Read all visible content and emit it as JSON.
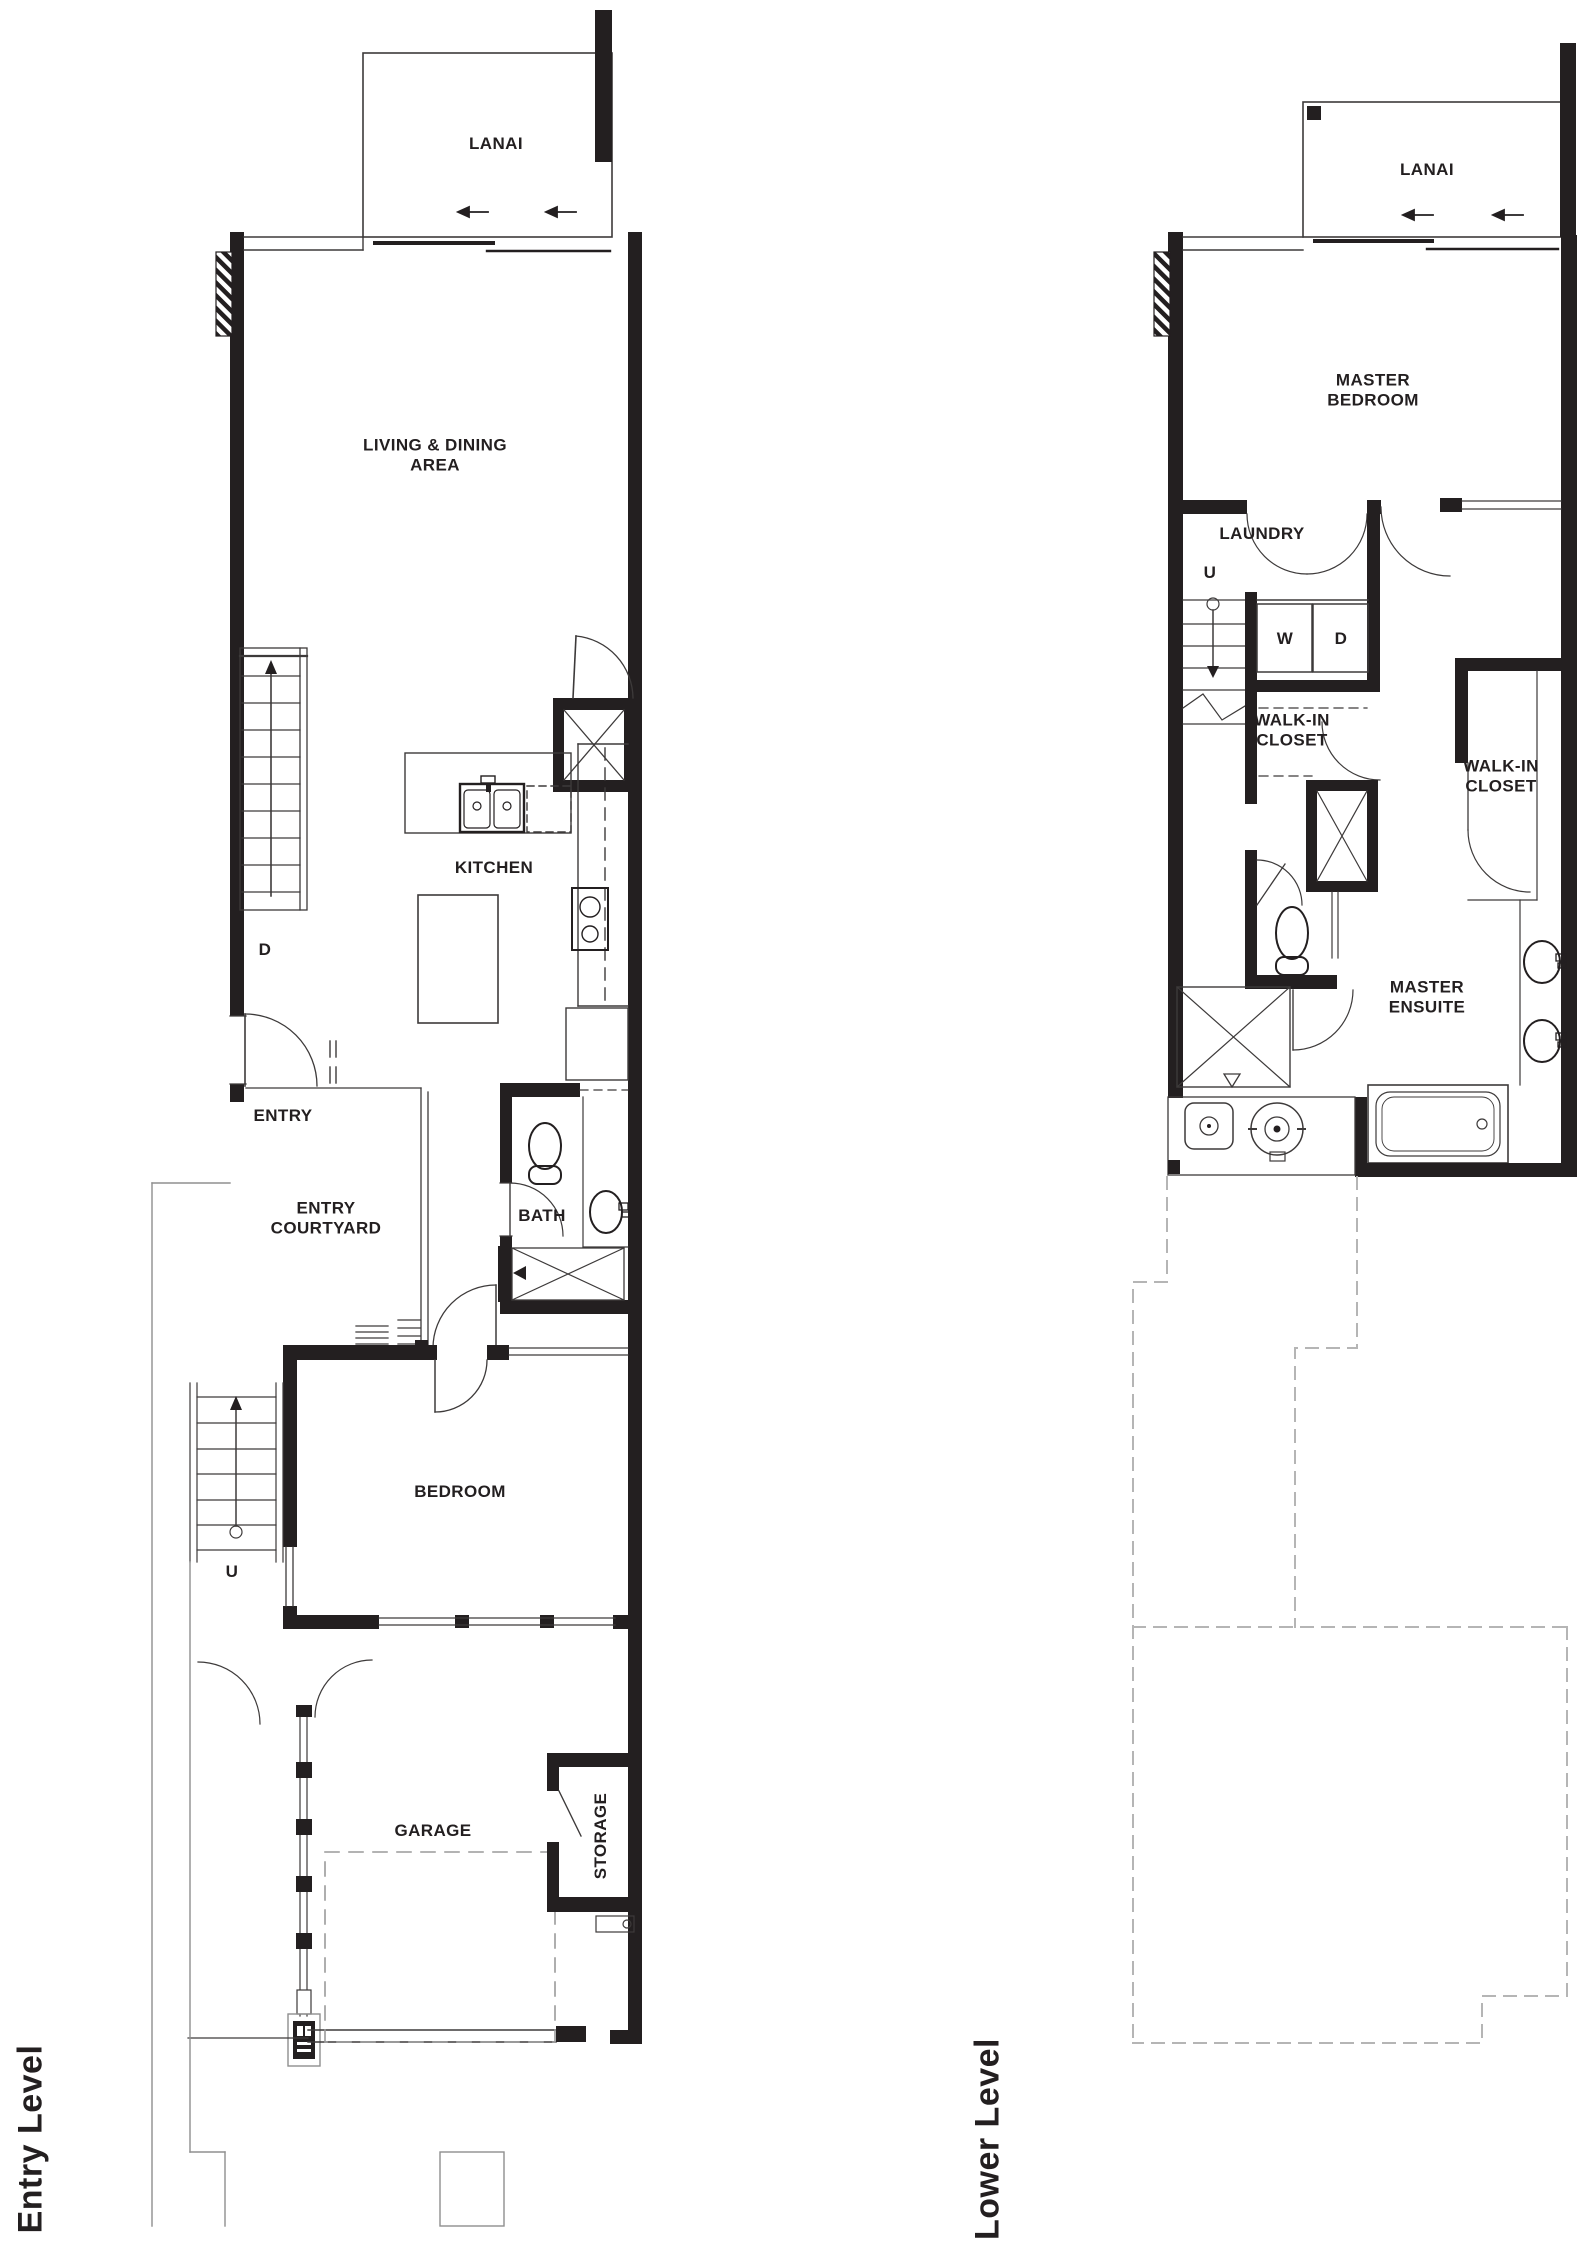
{
  "colors": {
    "ink": "#231f20",
    "thin_line": "#3d3a3a",
    "dashed_outline": "#b5b5b5",
    "lot_line": "#8f8f8f",
    "garage_dash": "#9a9a9a"
  },
  "entry_level": {
    "title": "Entry Level",
    "rooms": {
      "lanai": "LANAI",
      "living_dining": "LIVING & DINING\nAREA",
      "kitchen": "KITCHEN",
      "entry": "ENTRY",
      "entry_courtyard": "ENTRY\nCOURTYARD",
      "bath": "BATH",
      "bedroom": "BEDROOM",
      "garage": "GARAGE",
      "storage": "STORAGE"
    },
    "stairs": {
      "down": "D",
      "up": "U"
    }
  },
  "lower_level": {
    "title": "Lower Level",
    "rooms": {
      "lanai": "LANAI",
      "master_bedroom": "MASTER\nBEDROOM",
      "laundry": "LAUNDRY",
      "walk_in_closet_left": "WALK-IN\nCLOSET",
      "walk_in_closet_right": "WALK-IN\nCLOSET",
      "master_ensuite": "MASTER\nENSUITE"
    },
    "stairs": {
      "up": "U"
    },
    "appliances": {
      "washer": "W",
      "dryer": "D"
    }
  }
}
